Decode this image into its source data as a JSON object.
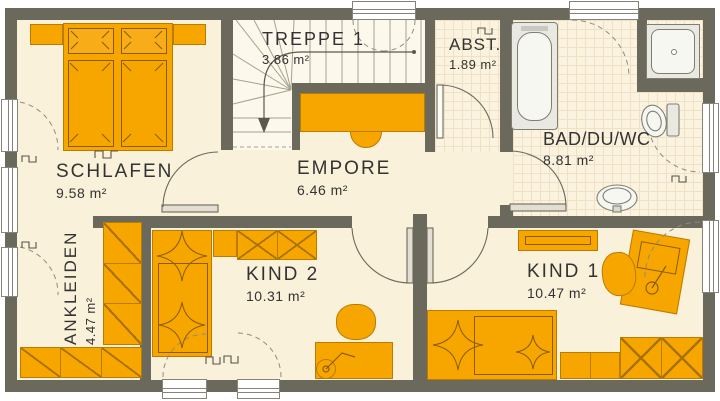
{
  "floor_plan": {
    "title": "Obergeschoss Grundriss",
    "rooms": [
      {
        "id": "schlafen",
        "name": "SCHLAFEN",
        "area": "9.58 m²"
      },
      {
        "id": "ankleiden",
        "name": "ANKLEIDEN",
        "area": "4.47 m²"
      },
      {
        "id": "treppe1",
        "name": "TREPPE 1",
        "area": "3.86 m²"
      },
      {
        "id": "empore",
        "name": "EMPORE",
        "area": "6.46 m²"
      },
      {
        "id": "abst",
        "name": "ABST.",
        "area": "1.89 m²"
      },
      {
        "id": "bad",
        "name": "BAD/DU/WC",
        "area": "8.81 m²"
      },
      {
        "id": "kind2",
        "name": "KIND 2",
        "area": "10.31 m²"
      },
      {
        "id": "kind1",
        "name": "KIND 1",
        "area": "10.47 m²"
      }
    ],
    "colors": {
      "wall": "#6B695B",
      "floor": "#FAF1DA",
      "stair_floor": "#FCF8EC",
      "tile_floor": "#FBF3E0",
      "tile_line": "#EFE2C2",
      "furniture": "#F7A600",
      "furniture_outline": "#B97B00",
      "furniture_detail": "#8A5C00",
      "fixture_fill": "#E9E9E1",
      "fixture_stroke": "#7E7E74",
      "door_leaf": "#E2DED2",
      "dash": "#8F8C7C",
      "text": "#333333"
    }
  }
}
